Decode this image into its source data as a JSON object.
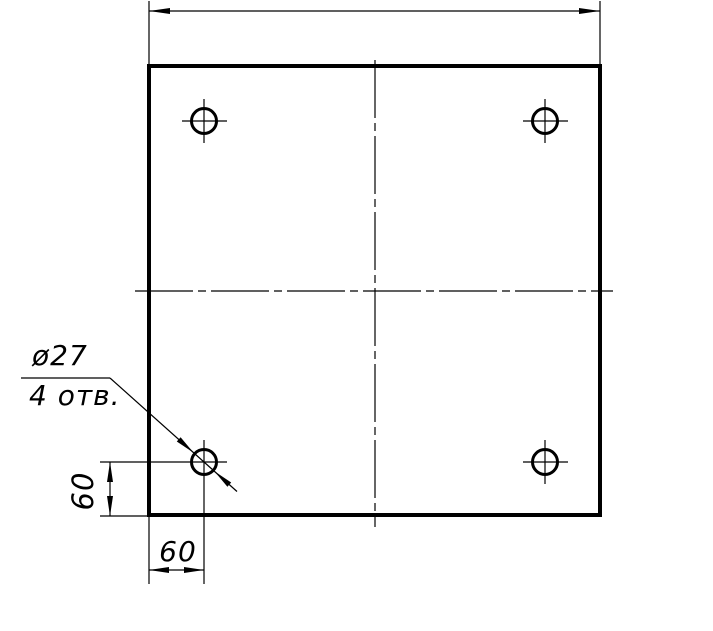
{
  "drawing": {
    "type": "engineering-drawing",
    "view": "square plate with 4 drilled holes, top view",
    "callout": {
      "line1": "ø27",
      "line2": "4 отв."
    },
    "dimensions": {
      "hole_offset_vertical": "60",
      "hole_offset_horizontal": "60"
    },
    "holes": {
      "visible_count": 4
    },
    "colors": {
      "ink": "#000000",
      "paper": "#ffffff"
    }
  }
}
